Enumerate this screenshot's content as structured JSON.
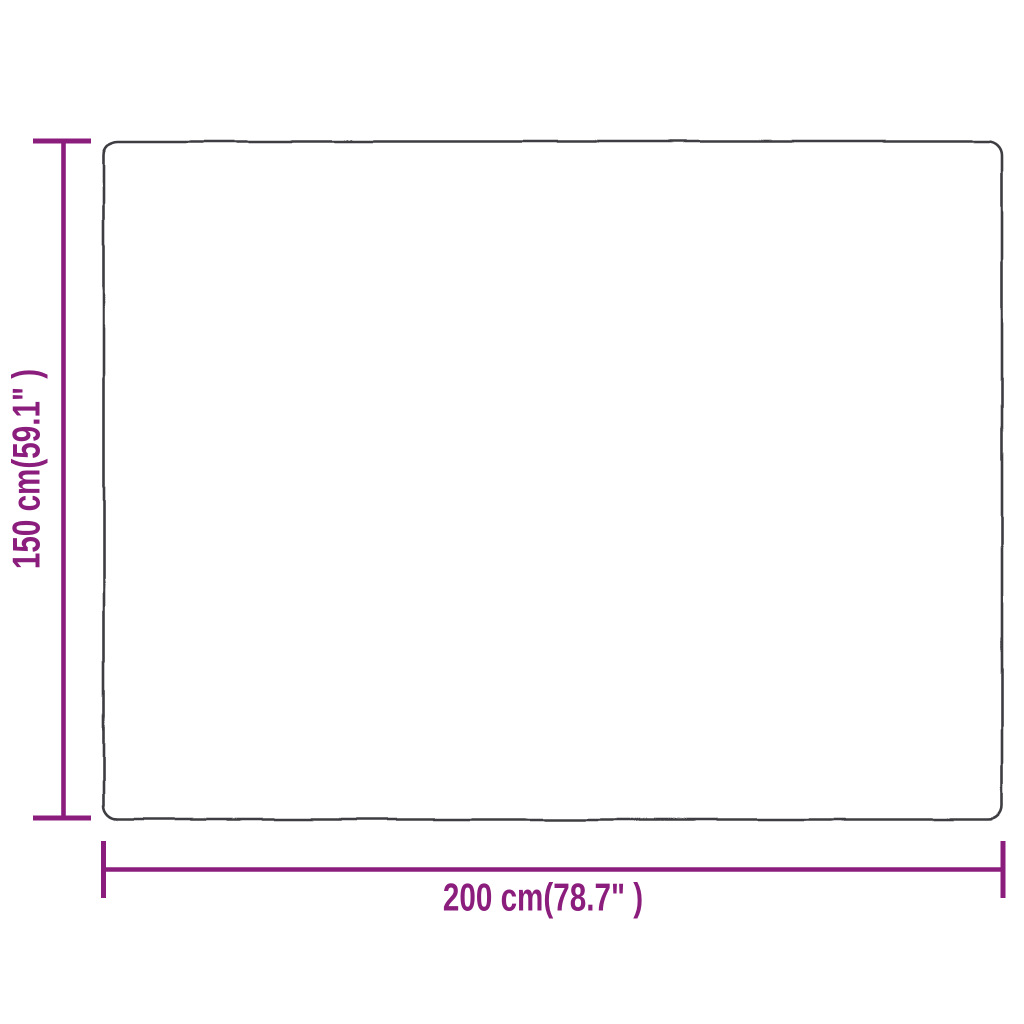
{
  "diagram": {
    "type": "product-dimension-diagram",
    "background_color": "#ffffff",
    "outline_color": "#3e3e42",
    "accent_color": "#8b1e7d",
    "height_dimension": {
      "label": "150 cm(59.1\" )",
      "cm": 150,
      "inches": 59.1
    },
    "width_dimension": {
      "label": "200 cm(78.7\" )",
      "cm": 200,
      "inches": 78.7
    }
  }
}
